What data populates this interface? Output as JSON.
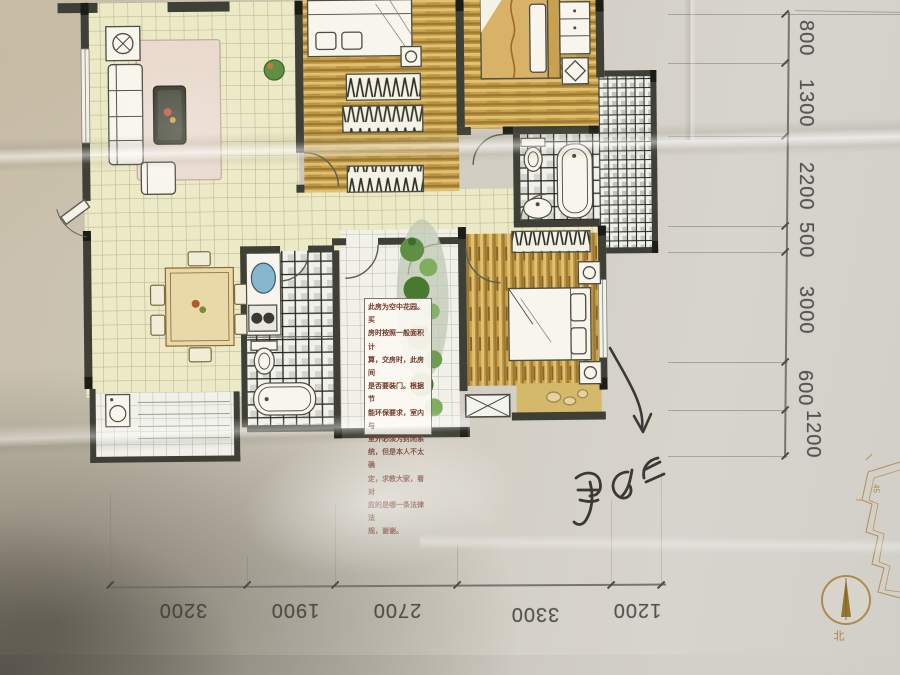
{
  "annotation_box": {
    "text": "此房为空中花园。买\n房时按照一般面积计\n算，交房时，此房间\n是否要装门。根据节\n能环保要求，室内与\n室外必须为封闭系\n统，但是本人不太确\n定，求教大家，看对\n应的是哪一条法律法\n规，谢谢。"
  },
  "dimensions": {
    "right_mm": [
      "800",
      "1300",
      "2200",
      "500",
      "3000",
      "600",
      "1200"
    ],
    "bottom_mm": [
      "3200",
      "1900",
      "2700",
      "3300",
      "1200"
    ]
  },
  "compass": {
    "north_label": "北"
  },
  "key_plan": {
    "label": "45"
  },
  "handwriting": {
    "description": "illegible handwritten characters beside a hand-drawn arrow pointing at the lower bedroom balcony"
  },
  "colors": {
    "paper": "#cfc8b8",
    "wall": "#3e3f36",
    "wall-dark": "#1c1d16",
    "tile": "#ece9c6",
    "tile-line": "#b4b18c",
    "tile-white": "#f1f1e9",
    "wood1": "#c9a14b",
    "wood2": "#9c7830",
    "wood3": "#e0c172",
    "check-dark": "#26261f",
    "plant": "#5e8f44",
    "plant-dark": "#3f6b2a",
    "furn": "#f7f5ec",
    "furn-line": "#4b4c42",
    "ink": "#3b3835",
    "dim": "#3e3e3c",
    "dimline": "#76766e",
    "note-text": "#703629",
    "compass": "#ae8a4c",
    "blanket": "#d9b269",
    "rug": "#e9dacd",
    "tan": "#d4b96a",
    "sink": "#88b6cc"
  }
}
